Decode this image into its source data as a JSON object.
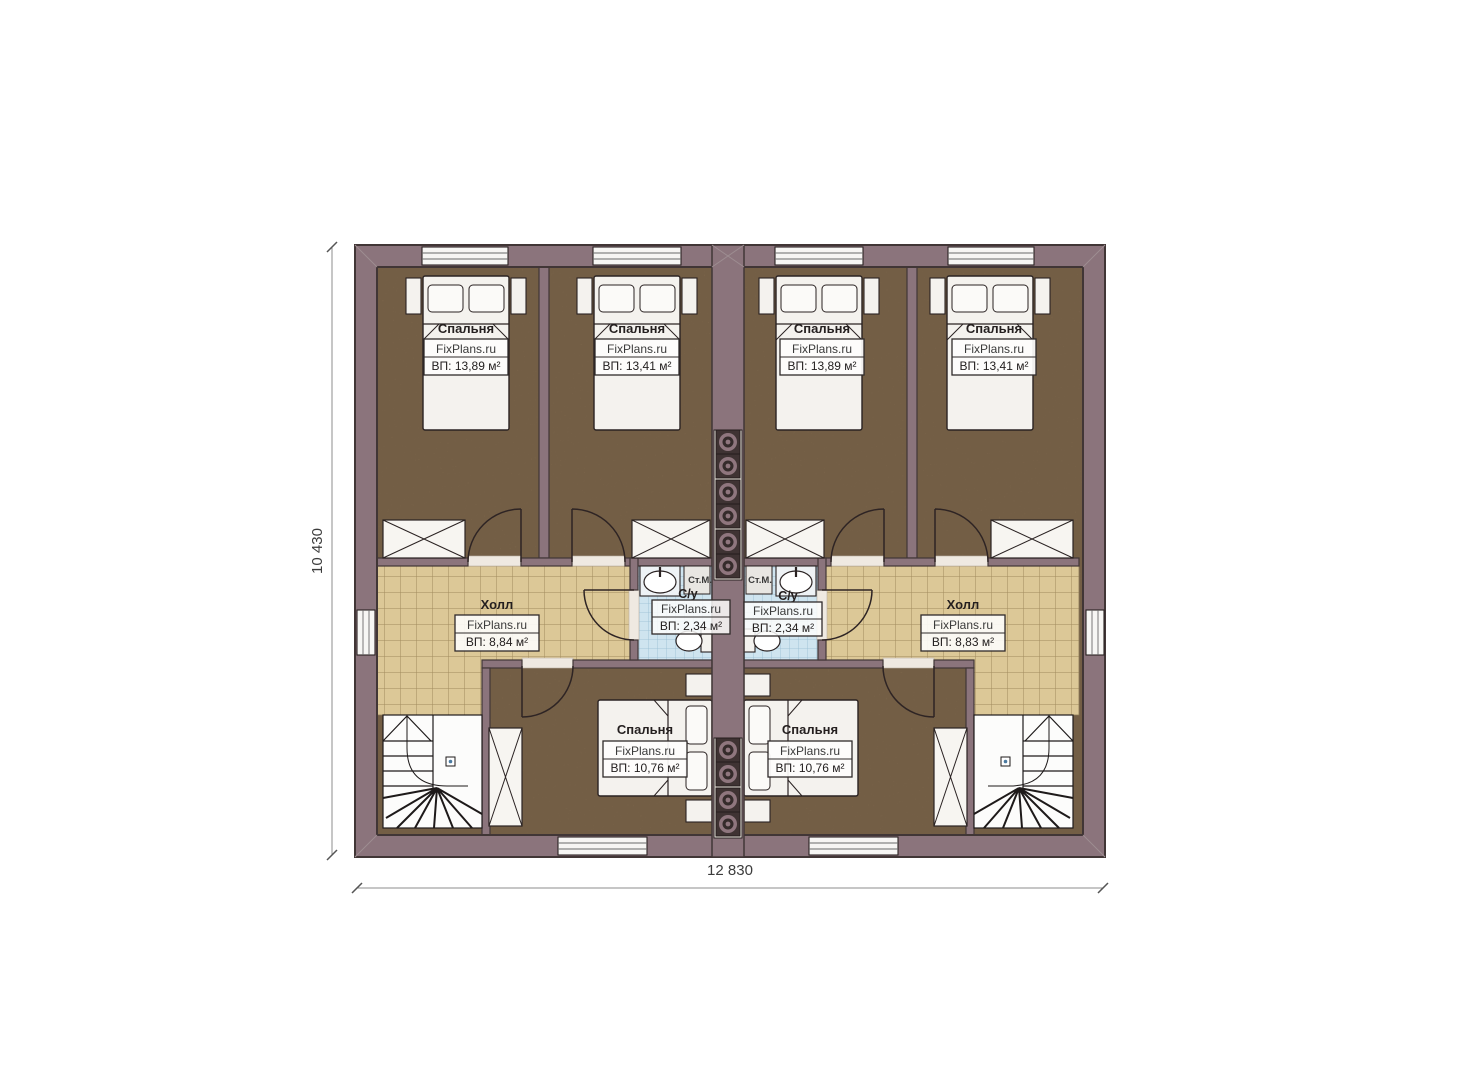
{
  "plan": {
    "type": "floor-plan",
    "watermark": "FixPlans.ru",
    "dimensions": {
      "width_label": "12 830",
      "height_label": "10 430"
    },
    "labels": {
      "washer": "Ст.М."
    },
    "rooms": {
      "bedroom_top_1": {
        "name": "Спальня",
        "watermark": "FixPlans.ru",
        "area": "ВП: 13,89 м²"
      },
      "bedroom_top_2": {
        "name": "Спальня",
        "watermark": "FixPlans.ru",
        "area": "ВП: 13,41 м²"
      },
      "bedroom_top_3": {
        "name": "Спальня",
        "watermark": "FixPlans.ru",
        "area": "ВП: 13,89 м²"
      },
      "bedroom_top_4": {
        "name": "Спальня",
        "watermark": "FixPlans.ru",
        "area": "ВП: 13,41 м²"
      },
      "hall_left": {
        "name": "Холл",
        "watermark": "FixPlans.ru",
        "area": "ВП: 8,84 м²"
      },
      "hall_right": {
        "name": "Холл",
        "watermark": "FixPlans.ru",
        "area": "ВП: 8,83 м²"
      },
      "bathroom_left": {
        "name": "С/у",
        "watermark": "FixPlans.ru",
        "area": "ВП: 2,34 м²"
      },
      "bathroom_right": {
        "name": "С/у",
        "watermark": "FixPlans.ru",
        "area": "ВП: 2,34 м²"
      },
      "bedroom_bottom_left": {
        "name": "Спальня",
        "watermark": "FixPlans.ru",
        "area": "ВП: 10,76 м²"
      },
      "bedroom_bottom_right": {
        "name": "Спальня",
        "watermark": "FixPlans.ru",
        "area": "ВП: 10,76 м²"
      }
    },
    "colors": {
      "wall": "#8b747c",
      "wall_outline": "#413636",
      "bedroom_floor": "#8a7153",
      "hall_tile": "#dcc897",
      "bath_tile": "#cfe4ef",
      "furniture": "#f4f2ee"
    }
  }
}
